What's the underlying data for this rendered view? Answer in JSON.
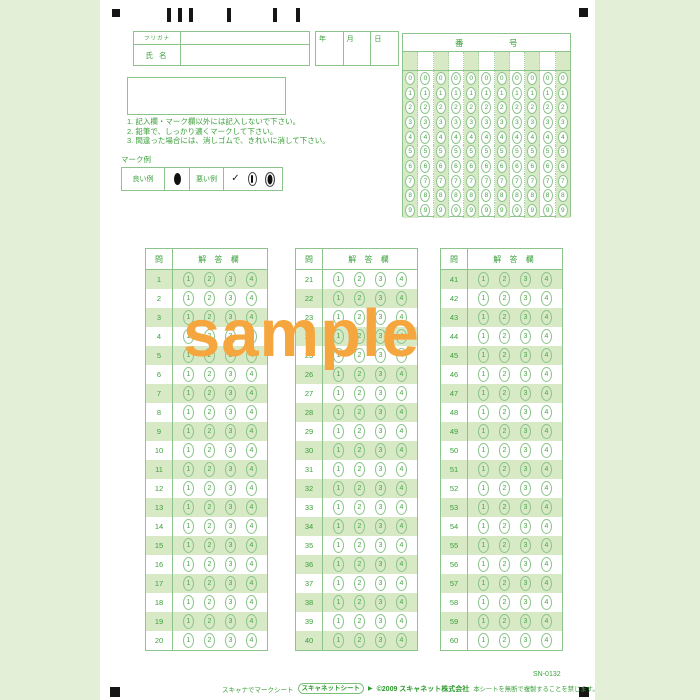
{
  "colors": {
    "background": "#e4efd8",
    "page": "#ffffff",
    "line_green": "#8cc48c",
    "text_green": "#3aa03a",
    "row_shade": "#d8e9c6",
    "mark_black": "#161616",
    "watermark_orange": "#f6a63e"
  },
  "name_box": {
    "kana_label": "フリガナ",
    "name_label": "氏 名",
    "kana_value": "",
    "name_value": ""
  },
  "date_box": {
    "labels": [
      "年",
      "月",
      "日"
    ]
  },
  "number_grid": {
    "title": [
      "番",
      "号"
    ],
    "columns": 11,
    "digits": [
      "0",
      "1",
      "2",
      "3",
      "4",
      "5",
      "6",
      "7",
      "8",
      "9"
    ]
  },
  "instructions": [
    "1. 記入欄・マーク欄以外には記入しないで下さい。",
    "2. 鉛筆で、しっかり濃くマークして下さい。",
    "3. 間違った場合には、消しゴムで、きれいに消して下さい。"
  ],
  "mark_example": {
    "title": "マーク例",
    "good_label": "良い例",
    "bad_label": "悪い例",
    "check_glyph": "✓"
  },
  "answer_section": {
    "question_header": "問",
    "answer_header": "解 答 欄",
    "choices": [
      "1",
      "2",
      "3",
      "4"
    ],
    "blocks": [
      {
        "start": 1,
        "end": 20,
        "shade_first": true
      },
      {
        "start": 21,
        "end": 40,
        "shade_first": false
      },
      {
        "start": 41,
        "end": 60,
        "shade_first": true
      }
    ]
  },
  "watermark": "sample",
  "footer": {
    "tagline": "スキャナでマークシート",
    "logo": "スキャネットシート",
    "logo_arrow": "▶",
    "copyright": "©2009 スキャネット株式会社",
    "notice": "本シートを無断で複製することを禁じます。",
    "code": "SN-0132"
  }
}
